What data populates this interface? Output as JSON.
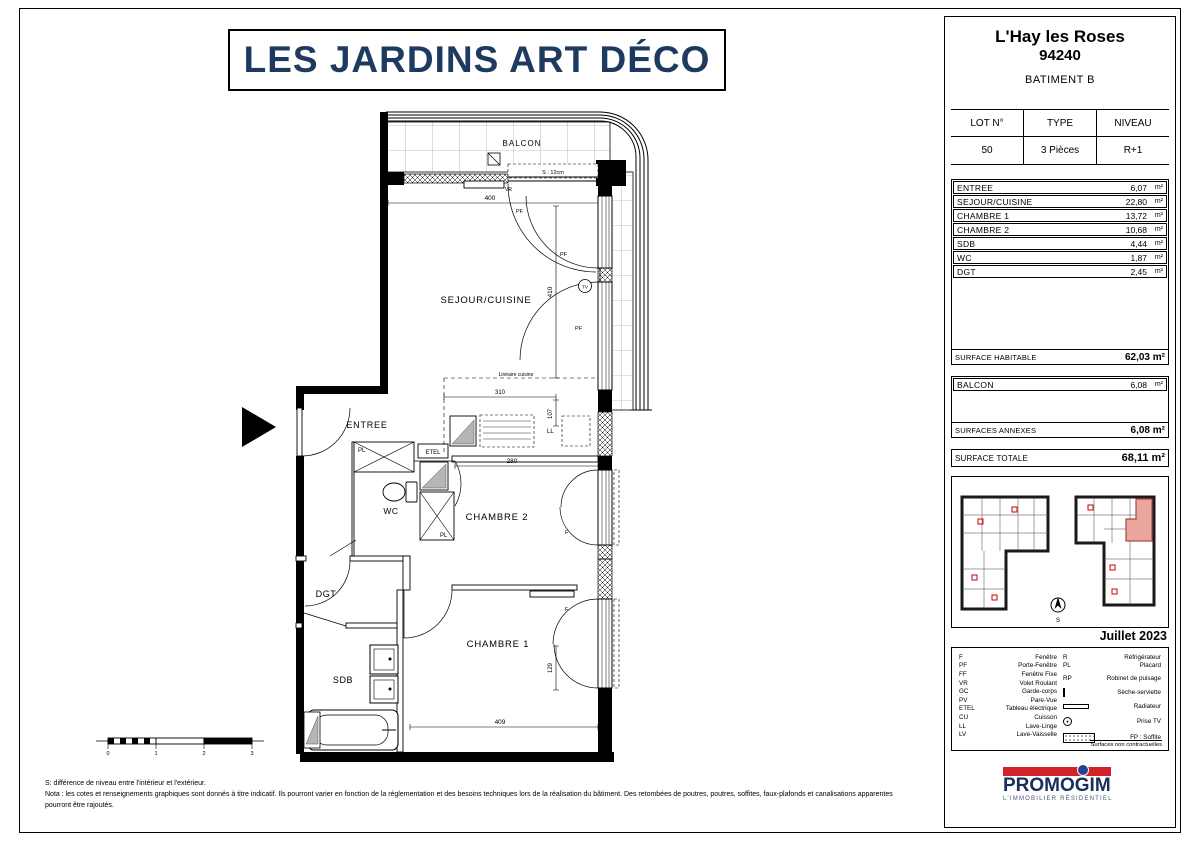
{
  "title": "LES JARDINS ART DÉCO",
  "project": {
    "city": "L'Hay les Roses",
    "postal_code": "94240",
    "building": "BATIMENT B"
  },
  "lot": {
    "headers": [
      "LOT N°",
      "TYPE",
      "NIVEAU"
    ],
    "values": [
      "50",
      "3 Pièces",
      "R+1"
    ]
  },
  "rooms": {
    "unit": "m²",
    "rows": [
      {
        "name": "ENTREE",
        "area": "6,07"
      },
      {
        "name": "SEJOUR/CUISINE",
        "area": "22,80"
      },
      {
        "name": "CHAMBRE 1",
        "area": "13,72"
      },
      {
        "name": "CHAMBRE 2",
        "area": "10,68"
      },
      {
        "name": "SDB",
        "area": "4,44"
      },
      {
        "name": "WC",
        "area": "1,87"
      },
      {
        "name": "DGT",
        "area": "2,45"
      }
    ],
    "habitable_label": "SURFACE HABITABLE",
    "habitable_value": "62,03 m²"
  },
  "annexes": {
    "unit": "m²",
    "rows": [
      {
        "name": "BALCON",
        "area": "6,08"
      }
    ],
    "label": "SURFACES ANNEXES",
    "value": "6,08 m²"
  },
  "total": {
    "label": "SURFACE TOTALE",
    "value": "68,11 m²"
  },
  "date": "Juillet 2023",
  "legend": {
    "left": [
      {
        "abbr": "F",
        "label": "Fenêtre"
      },
      {
        "abbr": "PF",
        "label": "Porte-Fenêtre"
      },
      {
        "abbr": "FF",
        "label": "Fenêtre Fixe"
      },
      {
        "abbr": "VR",
        "label": "Volet Roulant"
      },
      {
        "abbr": "GC",
        "label": "Garde-corps"
      },
      {
        "abbr": "PV",
        "label": "Pare-Vue"
      },
      {
        "abbr": "ETEL",
        "label": "Tableau électrique"
      },
      {
        "abbr": "CU",
        "label": "Cuisson"
      },
      {
        "abbr": "LL",
        "label": "Lave-Linge"
      },
      {
        "abbr": "LV",
        "label": "Lave-Vaisselle"
      }
    ],
    "right": [
      {
        "abbr": "R",
        "label": "Réfrigérateur"
      },
      {
        "abbr": "PL",
        "label": "Placard"
      },
      {
        "abbr": "RP",
        "label": "Robinet de puisage"
      },
      {
        "icon": "seche-serviette",
        "label": "Sèche-serviette"
      },
      {
        "icon": "radiateur",
        "label": "Radiateur"
      },
      {
        "icon": "prise-tv",
        "label": "Prise TV"
      },
      {
        "icon": "soffite",
        "label": "FP : Soffite"
      }
    ],
    "note": "Surfaces non contractuelles"
  },
  "logo": {
    "name": "PROMOGIM",
    "tagline": "L'IMMOBILIER RÉSIDENTIEL"
  },
  "plan": {
    "room_labels": {
      "balcon": "BALCON",
      "sejour": "SEJOUR/CUISINE",
      "entree": "ENTREE",
      "wc": "WC",
      "chambre2": "CHAMBRE 2",
      "dgt": "DGT",
      "chambre1": "CHAMBRE 1",
      "sdb": "SDB"
    },
    "annotations": {
      "pf": "PF",
      "f": "F",
      "vr": "VR",
      "pl": "PL",
      "etel": "ETEL",
      "ll": "LL",
      "tv": "TV",
      "threshold": "S : 12cm",
      "kitchen": "Linéaire cuisine",
      "compass": "S"
    },
    "dimensions": {
      "d400": "400",
      "d410": "410",
      "d310": "310",
      "d107": "107",
      "d280": "280",
      "d409": "409",
      "d129": "129"
    }
  },
  "scalebar": {
    "ticks": [
      "0",
      "1",
      "2",
      "3"
    ]
  },
  "footer": {
    "line1": "S: différence de niveau entre l'intérieur et l'extérieur.",
    "line2": "Nota : les cotes et renseignements graphiques sont donnés à titre indicatif. Ils pourront varier en fonction de la réglementation et des besoins techniques lors de la réalisation du bâtiment. Des retombées de poutres, poutres, soffites, faux-plafonds et canalisations apparentes pourront être rajoutés."
  }
}
